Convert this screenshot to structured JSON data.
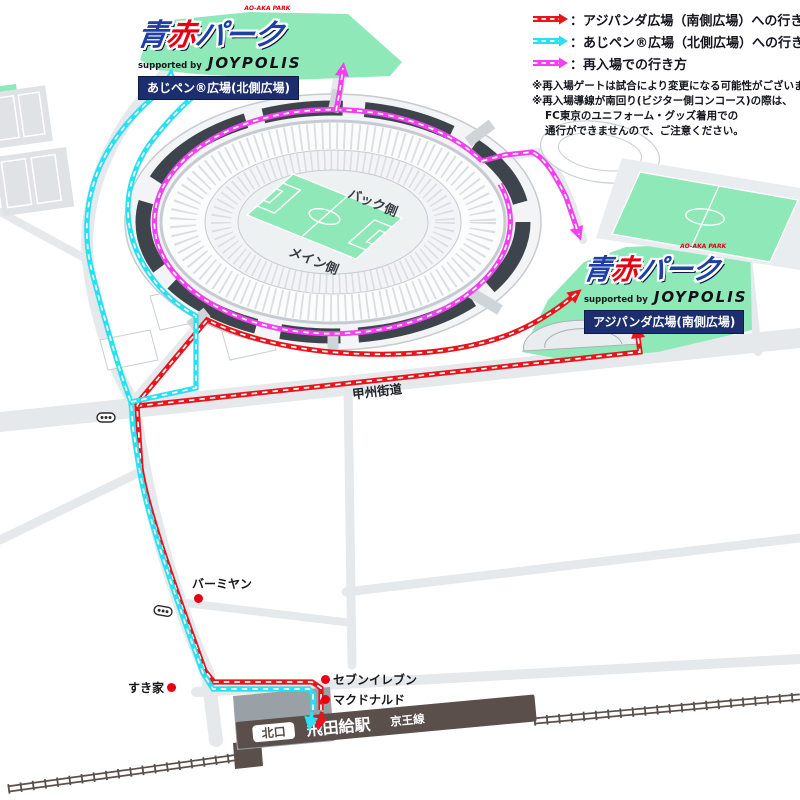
{
  "legend": {
    "items": [
      {
        "key": "south",
        "color": "#e8151d",
        "label": "：アジパンダ広場（南側広場）への行き方"
      },
      {
        "key": "north",
        "color": "#27e0f2",
        "label": "：あじペン®広場（北側広場）への行き方"
      },
      {
        "key": "reentry",
        "color": "#f23ff2",
        "label": "：再入場での行き方"
      }
    ],
    "notes": [
      "※再入場ゲートは試合により変更になる可能性がございます。",
      "※再入場導線が南回り(ビジター側コンコース)の際は、",
      "FC東京のユニフォーム・グッズ着用での",
      "通行ができませんので、ご注意ください。"
    ]
  },
  "logos": {
    "north": {
      "tagline": "AO-AKA PARK",
      "title_ao": "青",
      "title_aka": "赤",
      "title_park": "パーク",
      "supported_by": "supported by",
      "sponsor": "JOYPOLIS",
      "plaza": "あじペン®広場(北側広場)"
    },
    "south": {
      "tagline": "AO-AKA PARK",
      "title_ao": "青",
      "title_aka": "赤",
      "title_park": "パーク",
      "supported_by": "supported by",
      "sponsor": "JOYPOLIS",
      "plaza": "アジパンダ広場(南側広場)"
    }
  },
  "stadium": {
    "back_stand": "バック側",
    "main_stand": "メイン側"
  },
  "roads": {
    "koshu_kaido": "甲州街道"
  },
  "pois": {
    "bamiyan": "バーミヤン",
    "sukiya": "すき家",
    "seven_eleven": "セブンイレブン",
    "mcdonalds": "マクドナルド"
  },
  "station": {
    "gate": "北口",
    "name": "飛田給駅",
    "line": "京王線"
  },
  "colors": {
    "route_south": "#e8151d",
    "route_north": "#27e0f2",
    "route_reentry": "#f23ff2",
    "plaza_green": "#8fe8b8",
    "stadium_dark": "#3d444c",
    "station_brown": "#5b4f4b"
  }
}
